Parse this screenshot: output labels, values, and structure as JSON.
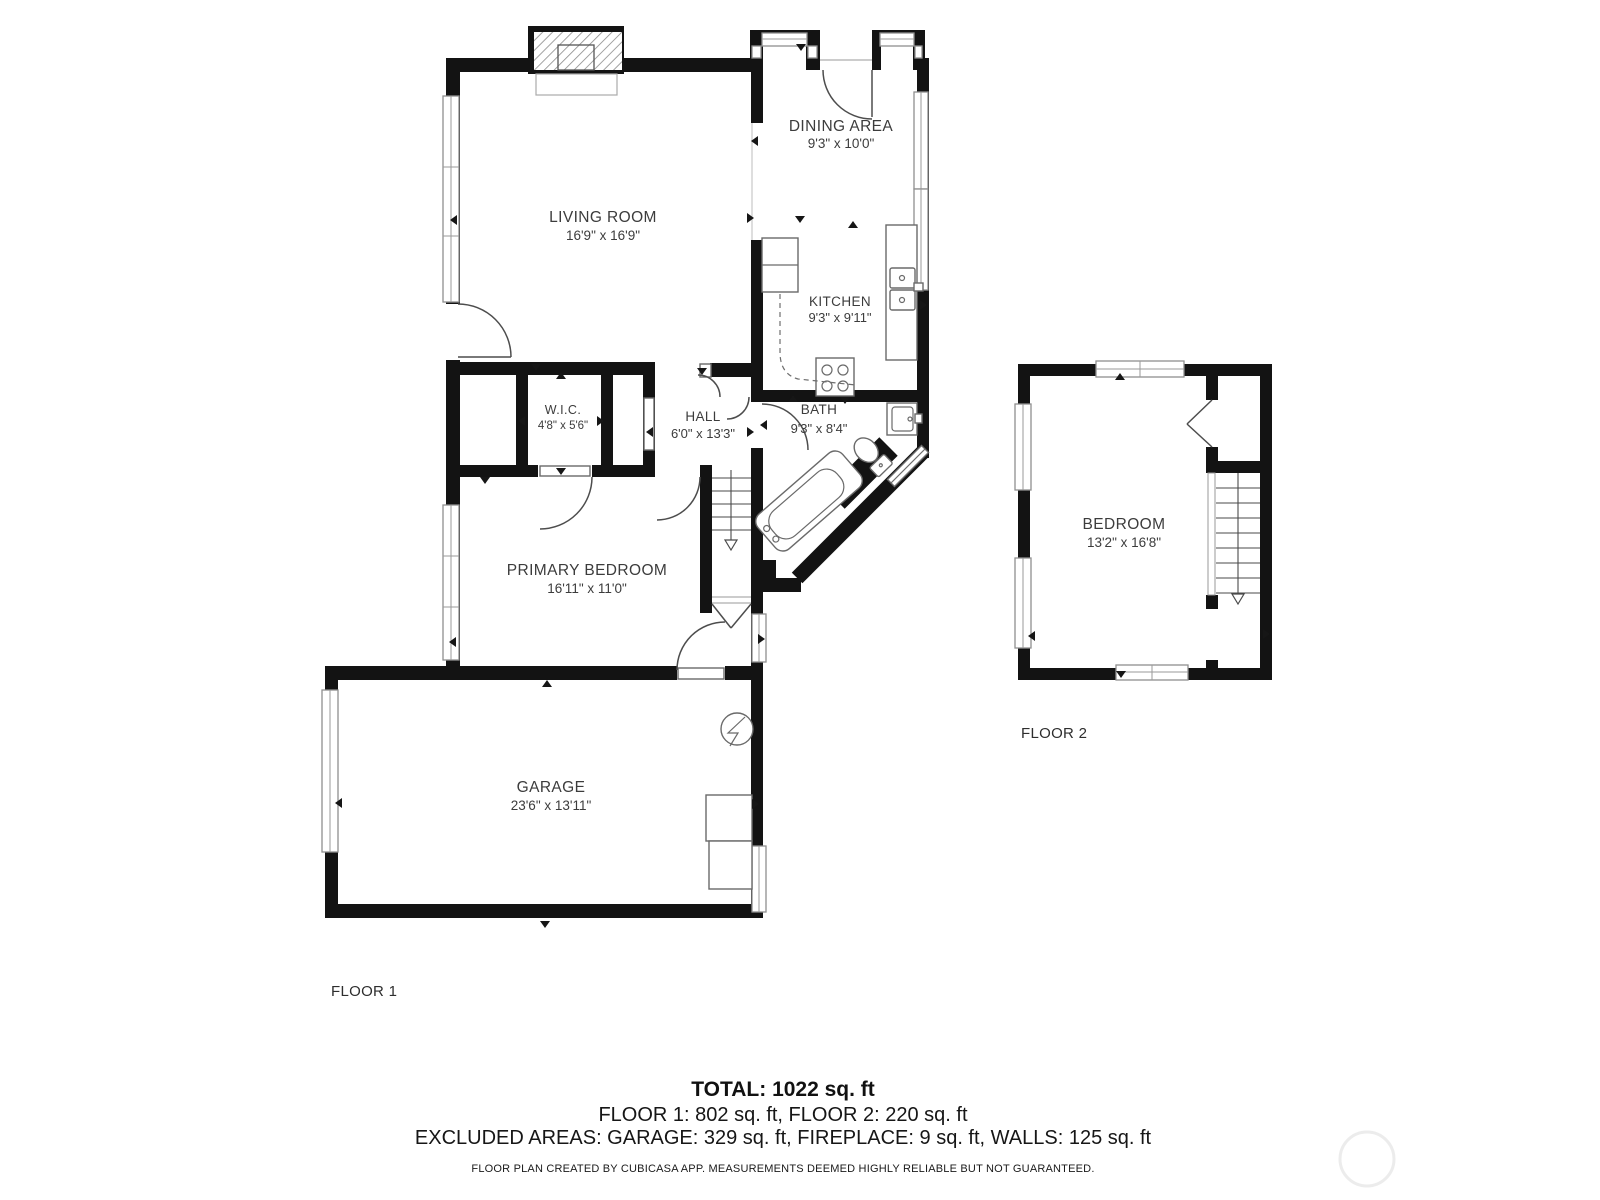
{
  "floorplan": {
    "colors": {
      "wall": "#131313",
      "line": "#4d4d4d",
      "window_frame": "#8f8f8f",
      "text": "#3c3c3c"
    },
    "rooms": [
      {
        "name": "LIVING ROOM",
        "dims": "16'9\" x 16'9\""
      },
      {
        "name": "DINING AREA",
        "dims": "9'3\" x 10'0\""
      },
      {
        "name": "KITCHEN",
        "dims": "9'3\" x 9'11\""
      },
      {
        "name": "W.I.C.",
        "dims": "4'8\" x 5'6\""
      },
      {
        "name": "HALL",
        "dims": "6'0\" x 13'3\""
      },
      {
        "name": "BATH",
        "dims": "9'3\" x 8'4\""
      },
      {
        "name": "PRIMARY BEDROOM",
        "dims": "16'11\" x 11'0\""
      },
      {
        "name": "GARAGE",
        "dims": "23'6\" x 13'11\""
      },
      {
        "name": "BEDROOM",
        "dims": "13'2\" x 16'8\""
      }
    ],
    "floor_labels": [
      "FLOOR 1",
      "FLOOR 2"
    ],
    "summary": {
      "total": "TOTAL: 1022 sq. ft",
      "floors": "FLOOR 1: 802 sq. ft, FLOOR 2: 220 sq. ft",
      "excluded": "EXCLUDED AREAS: GARAGE: 329 sq. ft, FIREPLACE: 9 sq. ft, WALLS: 125 sq. ft",
      "disclaimer": "FLOOR PLAN CREATED BY CUBICASA APP. MEASUREMENTS DEEMED HIGHLY RELIABLE BUT NOT GUARANTEED."
    }
  }
}
